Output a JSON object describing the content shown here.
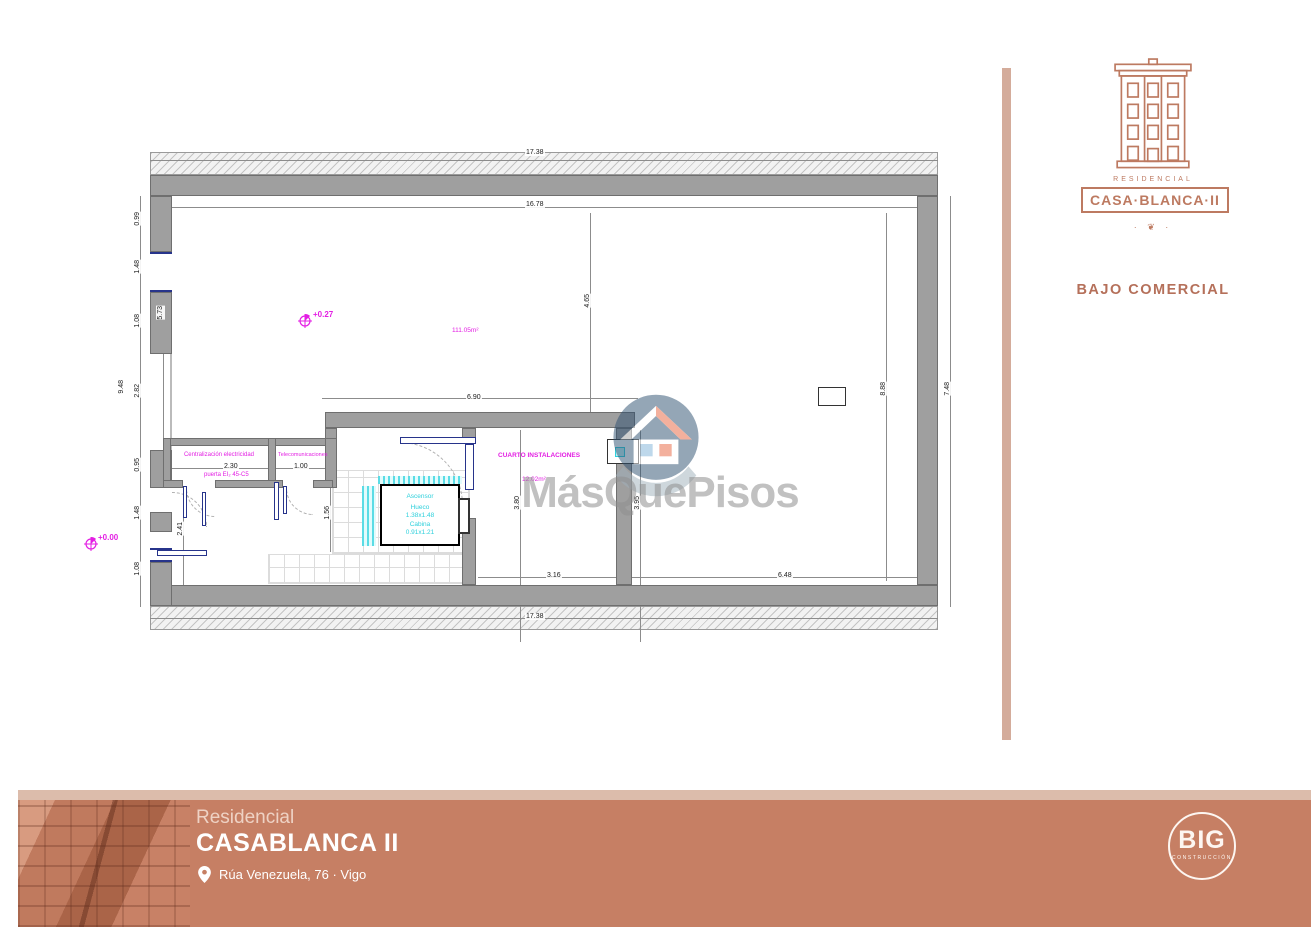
{
  "plan": {
    "labels": {
      "level_main": "+0.27",
      "area_main": "111.05m²",
      "level_entry": "+0.00",
      "room_elec": "Centralización electricidad",
      "room_elec_door": "puerta EI₂ 45-C5",
      "room_telecom": "Telecomunicaciones",
      "room_instal": "CUARTO INSTALACIONES",
      "room_instal_area": "12.02m²",
      "lift_title": "Ascensor",
      "lift_shaft_label": "Hueco",
      "lift_shaft_size": "1.38x1.48",
      "lift_cabin_label": "Cabina",
      "lift_cabin_size": "0.91x1.21"
    },
    "dims": {
      "top_outer": "17.38",
      "top_inner": "16.78",
      "bottom_outer": "17.38",
      "left_seg1": "0.99",
      "left_seg2": "1.48",
      "left_seg3": "1.08",
      "left_total": "9.48",
      "left_seg4": "2.82",
      "left_seg5": "0.95",
      "left_seg6": "1.48",
      "left_seg7": "1.08",
      "inner_left_upper": "5.73",
      "inner_left_lower": "2.41",
      "mid_height": "4.65",
      "inner_span": "6.90",
      "right_inner": "8.88",
      "right_outer": "7.48",
      "instal_height_left": "3.80",
      "instal_height_right": "3.95",
      "lobby_depth": "1.56",
      "instal_width": "3.16",
      "open_width": "6.48",
      "elec_width": "2.30",
      "telecom_width": "1.00"
    }
  },
  "watermark": {
    "brand": "MásQuePisos"
  },
  "side": {
    "residencial": "RESIDENCIAL",
    "brand": "CASA·BLANCA·II",
    "ornament": "· ❦ ·",
    "caption": "BAJO COMERCIAL"
  },
  "footer": {
    "line1": "Residencial",
    "line2": "CASABLANCA II",
    "address": "Rúa Venezuela, 76 · Vigo",
    "logo": "BIG",
    "logo_sub": "CONSTRUCCIÓN"
  },
  "colors": {
    "terracotta": "#c67f64",
    "terracotta_light": "#dcbcab",
    "logo_line": "#bd7a61",
    "wall_gray": "#9f9f9f",
    "magenta": "#e31ee3",
    "cyan": "#2fd0dc",
    "door_blue": "#27348b",
    "watermark_gray": "#8f8f8f"
  }
}
